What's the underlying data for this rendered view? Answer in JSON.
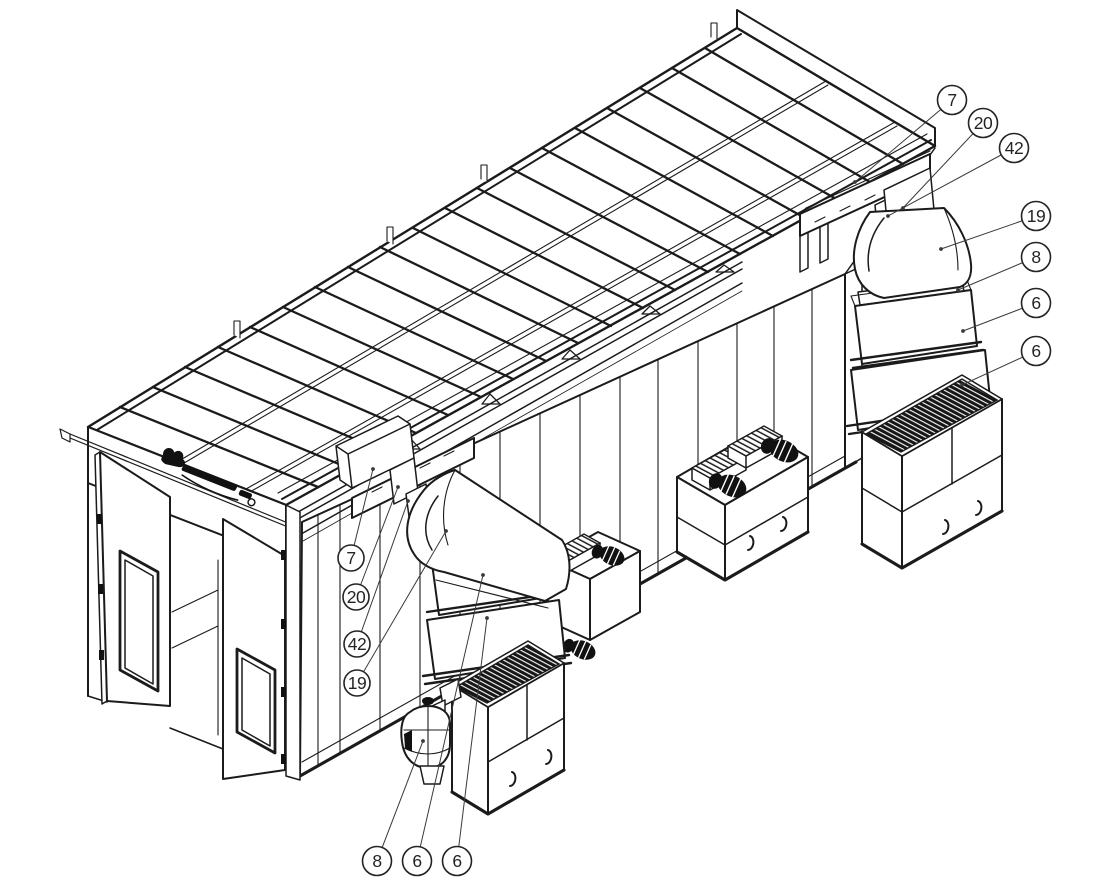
{
  "document": {
    "kind": "isometric exploded parts diagram",
    "subject": "spray booth with roof, front doors, side wall, exhaust towers and fan cabinets",
    "background_color": "#ffffff",
    "line_color": "#1b1b1b",
    "balloon_text_color": "#242424"
  },
  "brand_logo": {
    "present": true,
    "legible": false,
    "location": "front header panel above doors"
  },
  "part_numbers_visible": [
    "6",
    "7",
    "8",
    "19",
    "20",
    "42"
  ],
  "callouts": [
    {
      "label": "7",
      "group": "right-column"
    },
    {
      "label": "20",
      "group": "right-column"
    },
    {
      "label": "42",
      "group": "right-column"
    },
    {
      "label": "19",
      "group": "right-column"
    },
    {
      "label": "8",
      "group": "right-column"
    },
    {
      "label": "6",
      "group": "right-column"
    },
    {
      "label": "6",
      "group": "right-column"
    },
    {
      "label": "7",
      "group": "middle-column"
    },
    {
      "label": "20",
      "group": "middle-column"
    },
    {
      "label": "42",
      "group": "middle-column"
    },
    {
      "label": "19",
      "group": "middle-column"
    },
    {
      "label": "8",
      "group": "bottom-row"
    },
    {
      "label": "6",
      "group": "bottom-row"
    },
    {
      "label": "6",
      "group": "bottom-row"
    }
  ]
}
